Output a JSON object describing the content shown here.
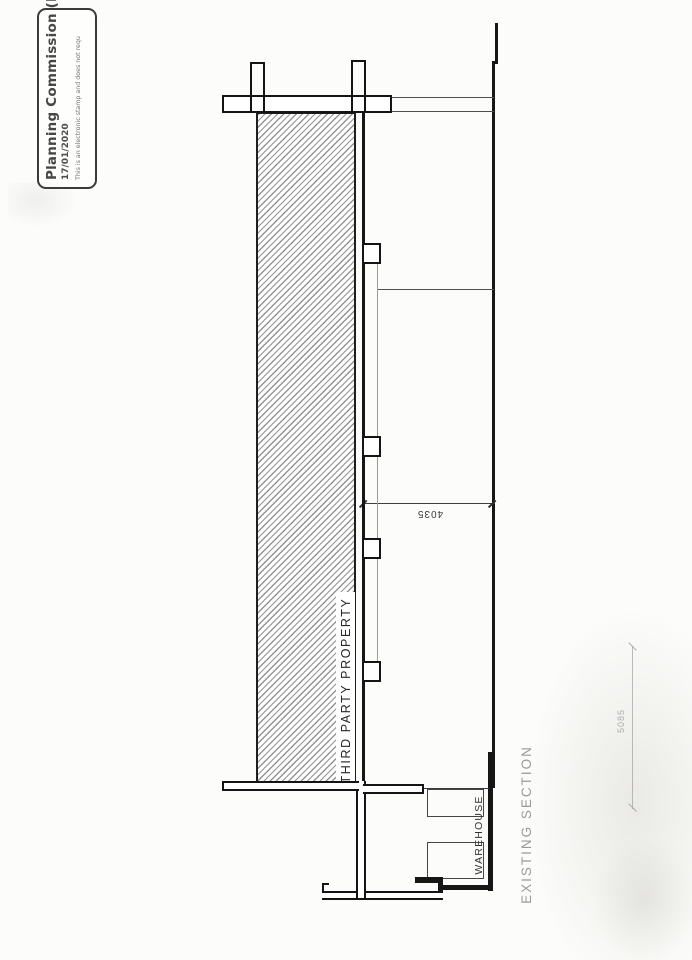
{
  "stamp": {
    "title": "Planning Commission (Re",
    "date": "17/01/2020",
    "disclaimer": "This is an electronic stamp and does not requ"
  },
  "drawing": {
    "title": "EXISTING SECTION",
    "labels": {
      "third_party": "THIRD PARTY PROPERTY",
      "warehouse": "WAREHOUSE"
    },
    "dimensions": [
      {
        "value": "4035"
      },
      {
        "value": "5085"
      }
    ],
    "colors": {
      "ink": "#161616",
      "faded_ink": "#9a9a9a",
      "paper": "#fcfcfa"
    }
  }
}
